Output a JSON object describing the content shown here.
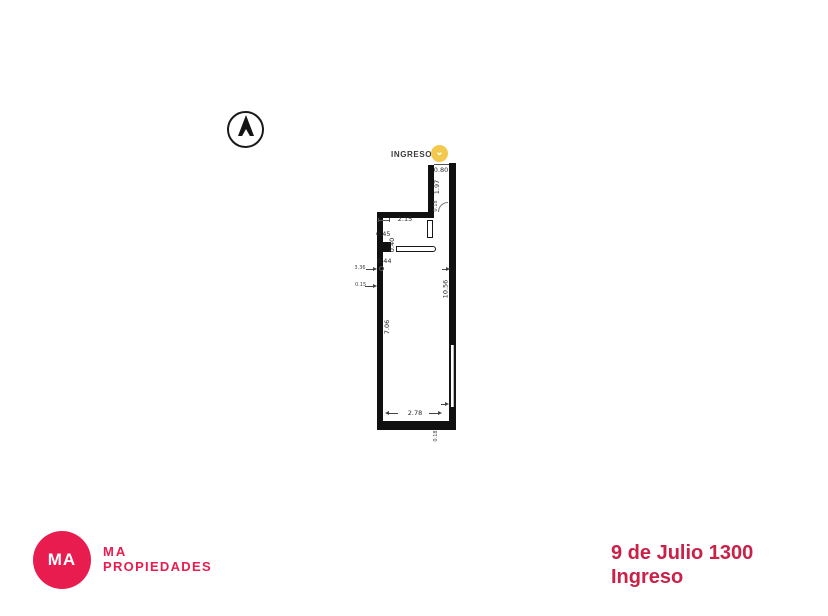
{
  "floor_plan": {
    "entrance": {
      "label": "INGRESO",
      "marker_glyph": "⌄",
      "marker_color": "#f2c94c"
    },
    "dimensions": {
      "door_opening": "0.80",
      "corridor_length": "1.97",
      "corridor_wall_thickness": "0.18",
      "top_width": "2.15",
      "niche_upper": "0.45",
      "column_depth": "0.40",
      "niche_lower": "0.44",
      "left_offset_upper": "3.36",
      "left_offset_lower": "0.15",
      "left_wall_length": "7.06",
      "right_wall_length": "10.56",
      "bottom_width": "2.78",
      "bottom_wall_thickness": "0.18"
    },
    "wall_color": "#101010"
  },
  "footer": {
    "logo_initials": "MA",
    "company_name_line1": "MA",
    "company_name_line2": "PROPIEDADES",
    "brand_color": "#e81c4f",
    "address_line1": "9 de Julio 1300",
    "address_line2": "Ingreso",
    "address_color": "#c92147"
  }
}
